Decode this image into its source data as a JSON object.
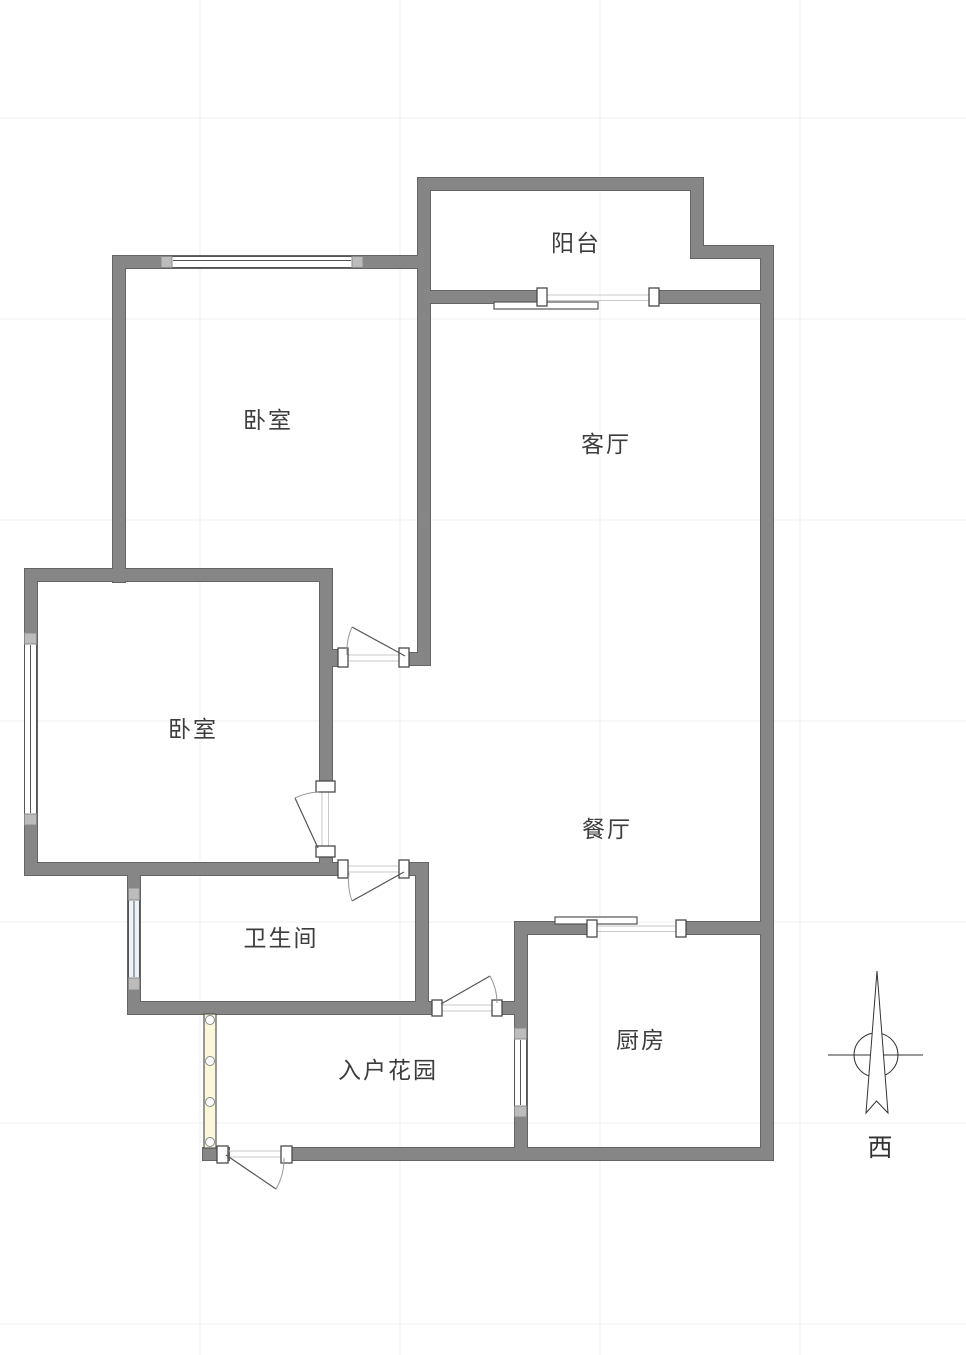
{
  "canvas": {
    "width": 966,
    "height": 1355,
    "background": "#ffffff"
  },
  "grid": {
    "color": "#f2f2f2",
    "vertical_x": [
      200,
      400,
      600,
      800
    ],
    "horizontal_y": [
      118,
      319,
      520,
      721,
      922,
      1123,
      1324
    ]
  },
  "palette": {
    "wall_fill": "#868686",
    "wall_stroke": "#646464",
    "jamb_fill": "#ffffff",
    "jamb_stroke": "#4a4a4a",
    "window_fill": "#ffffff",
    "window_tint": "#eaf2f8",
    "window_stroke": "#555555",
    "cap_fill": "#bcbcbc",
    "cap_stroke": "#8a8a8a",
    "track_color": "#c9c9c9",
    "leaf_color": "#555555",
    "arc_color": "#999999",
    "panel_fill": "#ffffff",
    "panel_stroke": "#555555",
    "fold_door_fill": "#fbf8da",
    "fold_door_stroke": "#555555",
    "compass_color": "#333333"
  },
  "rooms": [
    {
      "id": "balcony",
      "label": "阳台",
      "x": 576,
      "y": 241
    },
    {
      "id": "bedroom-1",
      "label": "卧室",
      "x": 268,
      "y": 418
    },
    {
      "id": "living-room",
      "label": "客厅",
      "x": 606,
      "y": 442
    },
    {
      "id": "bedroom-2",
      "label": "卧室",
      "x": 193,
      "y": 727
    },
    {
      "id": "dining-room",
      "label": "餐厅",
      "x": 607,
      "y": 827
    },
    {
      "id": "bathroom",
      "label": "卫生间",
      "x": 281,
      "y": 936
    },
    {
      "id": "entry-garden",
      "label": "入户花园",
      "x": 388,
      "y": 1068
    },
    {
      "id": "kitchen",
      "label": "厨房",
      "x": 641,
      "y": 1038
    }
  ],
  "compass": {
    "label": "西",
    "label_x": 880,
    "label_y": 1146,
    "circle": {
      "cx": 876,
      "cy": 1055,
      "r": 22
    },
    "cross_line": [
      828,
      1055,
      923,
      1055
    ],
    "arrow_points": "877,971 866,1113 876.5,1101 888,1113"
  },
  "plan": {
    "walls": [
      [
        418,
        178,
        285,
        12
      ],
      [
        691,
        178,
        12,
        80
      ],
      [
        691,
        246,
        82,
        12
      ],
      [
        761,
        246,
        12,
        914
      ],
      [
        418,
        178,
        12,
        487
      ],
      [
        418,
        291,
        122,
        12
      ],
      [
        656,
        291,
        117,
        12
      ],
      [
        113,
        256,
        317,
        12
      ],
      [
        113,
        256,
        12,
        326
      ],
      [
        25,
        569,
        307,
        12
      ],
      [
        25,
        569,
        12,
        306
      ],
      [
        320,
        569,
        12,
        222
      ],
      [
        320,
        847,
        12,
        28
      ],
      [
        320,
        650,
        22,
        16
      ],
      [
        403,
        653,
        27,
        12
      ],
      [
        25,
        863,
        316,
        12
      ],
      [
        401,
        863,
        27,
        12
      ],
      [
        128,
        863,
        12,
        151
      ],
      [
        416,
        863,
        12,
        151
      ],
      [
        128,
        1002,
        307,
        12
      ],
      [
        500,
        1002,
        27,
        12
      ],
      [
        515,
        922,
        12,
        238
      ],
      [
        515,
        922,
        80,
        12
      ],
      [
        679,
        922,
        94,
        12
      ],
      [
        203,
        1148,
        26,
        12
      ],
      [
        283,
        1148,
        490,
        12
      ]
    ],
    "windows": [
      {
        "name": "bedroom1-window",
        "rect": [
          161,
          256.5,
          202,
          11
        ],
        "caps": [
          [
            161,
            256.5,
            11,
            11
          ],
          [
            352,
            256.5,
            11,
            11
          ]
        ],
        "mid_line": [
          173,
          260.5,
          351,
          260.5
        ],
        "tinted": false
      },
      {
        "name": "bedroom2-window",
        "rect": [
          24.5,
          633,
          12,
          192
        ],
        "caps": [
          [
            24.5,
            633,
            12,
            11
          ],
          [
            24.5,
            814,
            12,
            11
          ]
        ],
        "mid_line": [
          30.5,
          645,
          30.5,
          813
        ],
        "tinted": false
      },
      {
        "name": "bathroom-window",
        "rect": [
          128.5,
          888,
          11,
          102
        ],
        "caps": [
          [
            128.5,
            888,
            11,
            12
          ],
          [
            128.5,
            978,
            11,
            12
          ]
        ],
        "mid_line": [
          134,
          901,
          134,
          977
        ],
        "tinted": true
      },
      {
        "name": "kitchen-window",
        "rect": [
          514.5,
          1028,
          12,
          89
        ],
        "caps": [
          [
            514.5,
            1028,
            12,
            11
          ],
          [
            514.5,
            1106,
            12,
            11
          ]
        ],
        "mid_line": [
          520.5,
          1040,
          520.5,
          1105
        ],
        "tinted": false
      }
    ],
    "jambs": [
      [
        537,
        288,
        10,
        18
      ],
      [
        649,
        288,
        10,
        18
      ],
      [
        338,
        648,
        10,
        19
      ],
      [
        399,
        648,
        10,
        19
      ],
      [
        316,
        781,
        19,
        11
      ],
      [
        316,
        846,
        19,
        11
      ],
      [
        338,
        860,
        10,
        18
      ],
      [
        399,
        860,
        10,
        18
      ],
      [
        432,
        1000,
        10,
        16
      ],
      [
        492,
        1000,
        10,
        16
      ],
      [
        587,
        920,
        10,
        17
      ],
      [
        676,
        920,
        10,
        17
      ],
      [
        217,
        1146,
        11,
        17
      ],
      [
        281,
        1146,
        11,
        17
      ]
    ],
    "swing_doors": [
      {
        "name": "bedroom1-door",
        "leaf": [
          405,
          656,
          352,
          627
        ],
        "arc": "M352,627 A60,60 0 0 0 347,655",
        "tracks": [
          [
            348,
            655,
            399,
            655
          ],
          [
            348,
            661,
            399,
            661
          ]
        ]
      },
      {
        "name": "bedroom2-door",
        "leaf": [
          318,
          848,
          295,
          798
        ],
        "arc": "M295,798 A57,57 0 0 1 319,792",
        "tracks": [
          [
            322,
            792,
            322,
            846
          ],
          [
            328.5,
            792,
            328.5,
            846
          ]
        ]
      },
      {
        "name": "bathroom-door",
        "leaf": [
          404,
          872,
          352,
          901
        ],
        "arc": "M352,901 A60,60 0 0 1 349,873",
        "tracks": [
          [
            348,
            866,
            399,
            866
          ],
          [
            348,
            872,
            399,
            872
          ]
        ]
      },
      {
        "name": "garden-dining-door",
        "leaf": [
          441,
          1004,
          490,
          976
        ],
        "arc": "M490,976 A56,56 0 0 1 497,1003",
        "tracks": [
          [
            442,
            1005,
            492,
            1005
          ],
          [
            442,
            1011,
            492,
            1011
          ]
        ]
      },
      {
        "name": "entry-front-door",
        "leaf": [
          226,
          1155,
          276,
          1189
        ],
        "arc": "M276,1189 A60,60 0 0 0 284,1158",
        "tracks": [
          [
            228,
            1151,
            281,
            1151
          ],
          [
            228,
            1157,
            281,
            1157
          ]
        ]
      }
    ],
    "sliding_doors": [
      {
        "name": "balcony-sliding-door",
        "tracks": [
          [
            547,
            295,
            650,
            295
          ],
          [
            547,
            300.5,
            650,
            300.5
          ]
        ],
        "panel": [
          494,
          302,
          104,
          7
        ]
      },
      {
        "name": "kitchen-sliding-door",
        "tracks": [
          [
            597,
            926,
            677,
            926
          ],
          [
            597,
            931.5,
            677,
            931.5
          ]
        ],
        "panel": [
          555,
          917,
          82,
          7
        ]
      }
    ],
    "fold_door": {
      "name": "garden-folding-door",
      "rect": [
        204,
        1014,
        12,
        134
      ],
      "hinge_cx": 210,
      "hinge_cy": [
        1020,
        1061,
        1102,
        1142
      ],
      "hinge_r": 4.5
    }
  }
}
